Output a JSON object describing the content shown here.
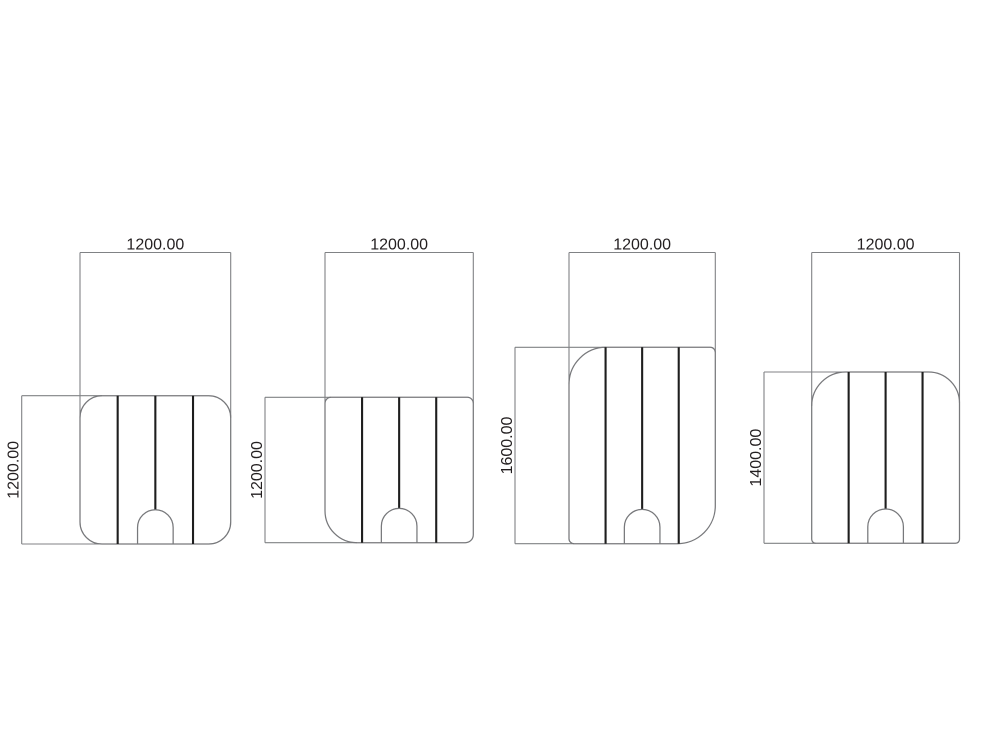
{
  "drawing": {
    "type": "technical-dimension-drawing",
    "background_color": "#ffffff",
    "outline_color": "#77787b",
    "dimension_line_color": "#808285",
    "seam_line_color": "#1e1e1e",
    "text_color": "#231f20",
    "seam_count_per_panel": 3,
    "has_bottom_arch_cutout": true,
    "diagrams": [
      {
        "name": "panel-1200x1200-all-corners-rounded",
        "width_label": "1200.00",
        "height_label": "1200.00",
        "width_value": 1200.0,
        "height_value": 1200.0,
        "rounded_corners": "all-four"
      },
      {
        "name": "panel-1200x1200-bottom-left-rounded",
        "width_label": "1200.00",
        "height_label": "1200.00",
        "width_value": 1200.0,
        "height_value": 1200.0,
        "rounded_corners": "bottom-left"
      },
      {
        "name": "panel-1200x1600-diagonal-rounded",
        "width_label": "1200.00",
        "height_label": "1600.00",
        "width_value": 1200.0,
        "height_value": 1600.0,
        "rounded_corners": "top-left-and-bottom-right"
      },
      {
        "name": "panel-1200x1400-top-rounded",
        "width_label": "1200.00",
        "height_label": "1400.00",
        "width_value": 1200.0,
        "height_value": 1400.0,
        "rounded_corners": "top-left-and-top-right"
      }
    ]
  }
}
